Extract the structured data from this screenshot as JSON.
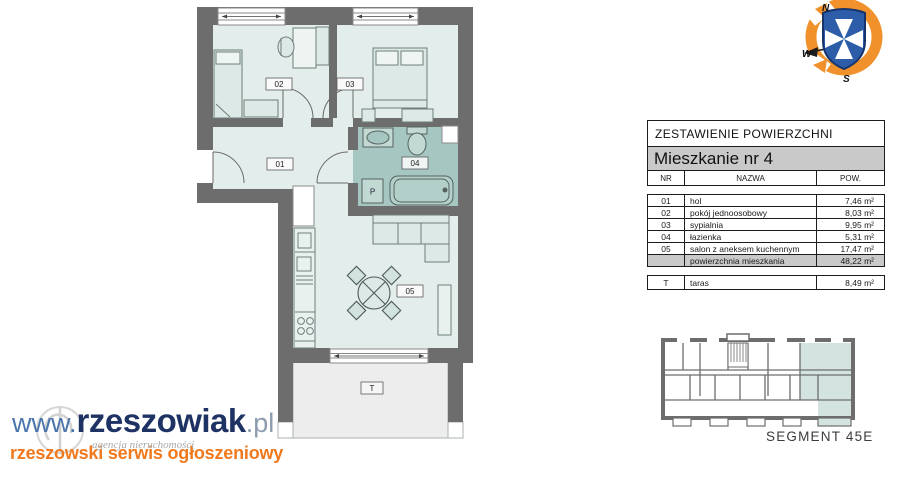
{
  "plan": {
    "room_labels": {
      "r01": "01",
      "r02": "02",
      "r03": "03",
      "r04": "04",
      "r05": "05"
    },
    "terrace_label": "T",
    "washer_label": "P"
  },
  "table": {
    "title": "ZESTAWIENIE POWIERZCHNI",
    "subtitle": "Mieszkanie nr 4",
    "columns": {
      "nr": "NR",
      "name": "NAZWA",
      "area": "POW."
    },
    "rows": [
      {
        "nr": "01",
        "name": "hol",
        "area": "7,46 m²"
      },
      {
        "nr": "02",
        "name": "pokój jednoosobowy",
        "area": "8,03 m²"
      },
      {
        "nr": "03",
        "name": "sypialnia",
        "area": "9,95 m²"
      },
      {
        "nr": "04",
        "name": "łazienka",
        "area": "5,31 m²"
      },
      {
        "nr": "05",
        "name": "salon z aneksem kuchennym",
        "area": "17,47 m²"
      }
    ],
    "summary": {
      "name": "powierzchnia mieszkania",
      "area": "48,22 m²"
    },
    "terrace_row": {
      "nr": "T",
      "name": "taras",
      "area": "8,49 m²"
    }
  },
  "compass": {
    "n": "N",
    "w": "W",
    "s": "S"
  },
  "segment": {
    "label": "SEGMENT 45E"
  },
  "logo": {
    "www": "www.",
    "name": "rzeszowiak",
    "tld": ".pl",
    "watermark": "agencja nieruchomości",
    "tagline": "rzeszowski serwis ogłoszeniowy"
  },
  "colors": {
    "wall": "#6d6d6d",
    "room_fill": "#e3edeb",
    "bath_fill": "#a6c7c1",
    "terrace_fill": "#ededed",
    "accent_orange": "#f0791e",
    "logo_navy": "#1e3264",
    "highlight_teal": "#d3e3df"
  }
}
